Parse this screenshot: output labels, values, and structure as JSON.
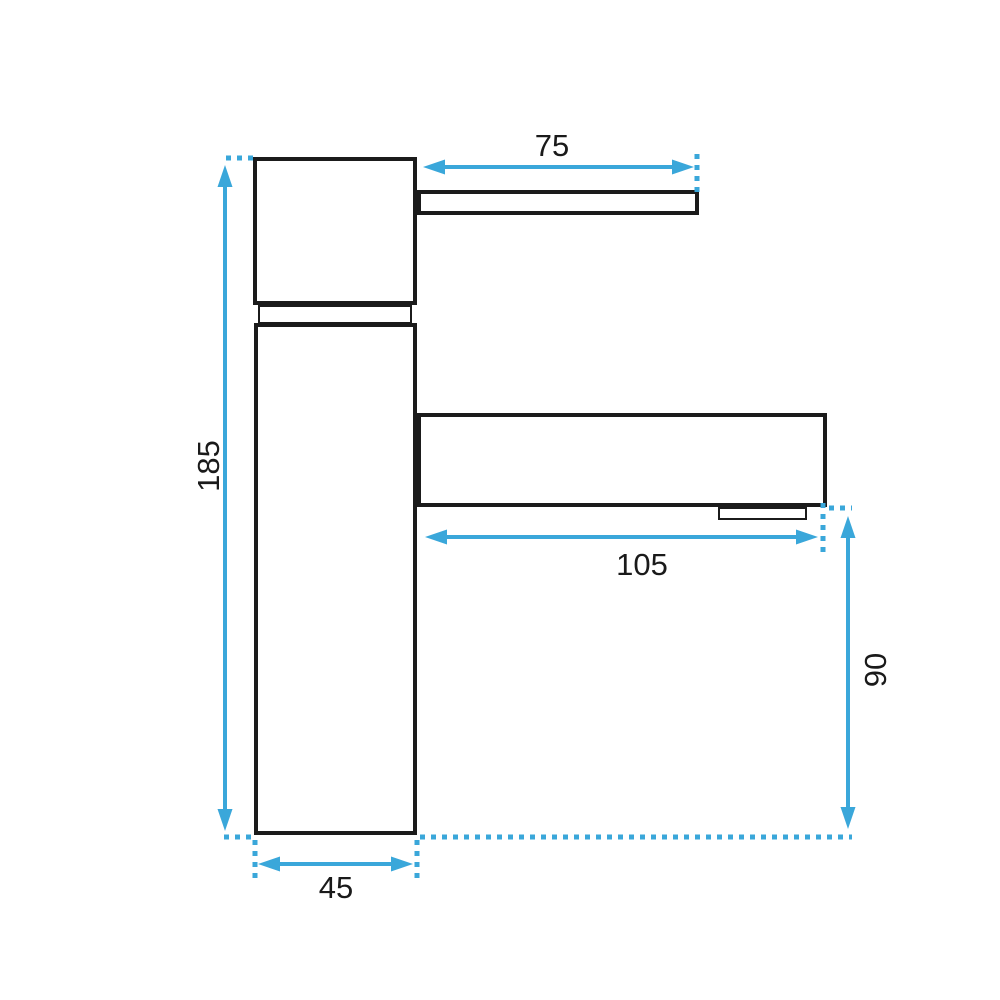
{
  "drawing": {
    "type": "technical-dimension-drawing",
    "subject": "single-lever basin faucet, side view",
    "dimensions": {
      "handle_length": "75",
      "total_height": "185",
      "spout_reach": "105",
      "spout_height": "90",
      "base_width": "45"
    }
  },
  "colors": {
    "accent": "#3aa7da",
    "outline": "#1b1b1b",
    "label_text": "#1a1a1a",
    "background": "#ffffff"
  }
}
